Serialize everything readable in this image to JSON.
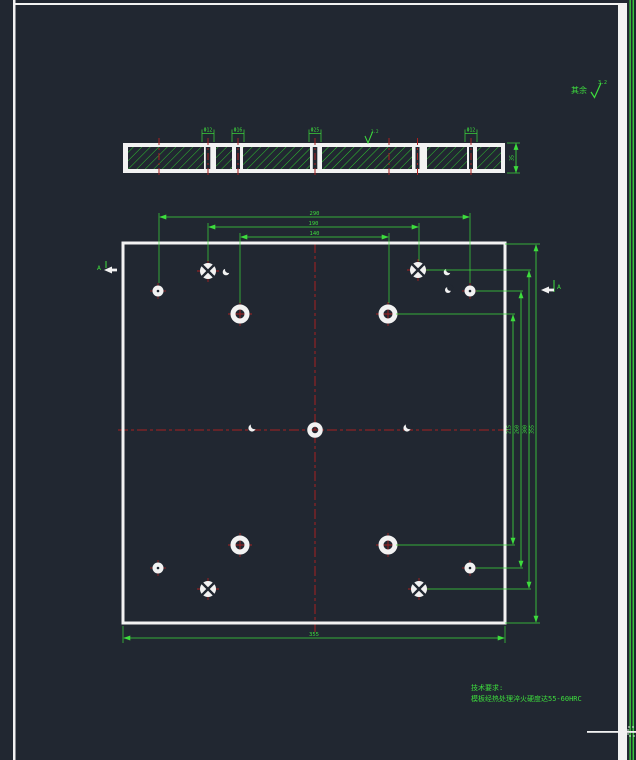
{
  "window": {
    "description": "CAD dark model-space view of a square mold plate drawing",
    "background": "#212731"
  },
  "palette": {
    "dim_green": "#3ddd3d",
    "hatch_green": "#2fc42f",
    "centerline_red": "#a62121",
    "entity_white": "#f2f2f2"
  },
  "corner_note": {
    "prefix": "其余",
    "roughness": "3.2"
  },
  "section_view": {
    "hole_dims": [
      "Φ12",
      "Φ16",
      "Φ25",
      "Φ12"
    ],
    "thickness": "35",
    "surface": "3.2"
  },
  "plan_view": {
    "dims_top": [
      "290",
      "190",
      "140"
    ],
    "dims_right": [
      "215",
      "260",
      "300",
      "355"
    ],
    "dim_bottom": "355",
    "section_label_left": "A",
    "section_label_right": "A"
  },
  "notes": {
    "title": "技术要求:",
    "body": "模板经热处理淬火硬度达55-60HRC"
  }
}
